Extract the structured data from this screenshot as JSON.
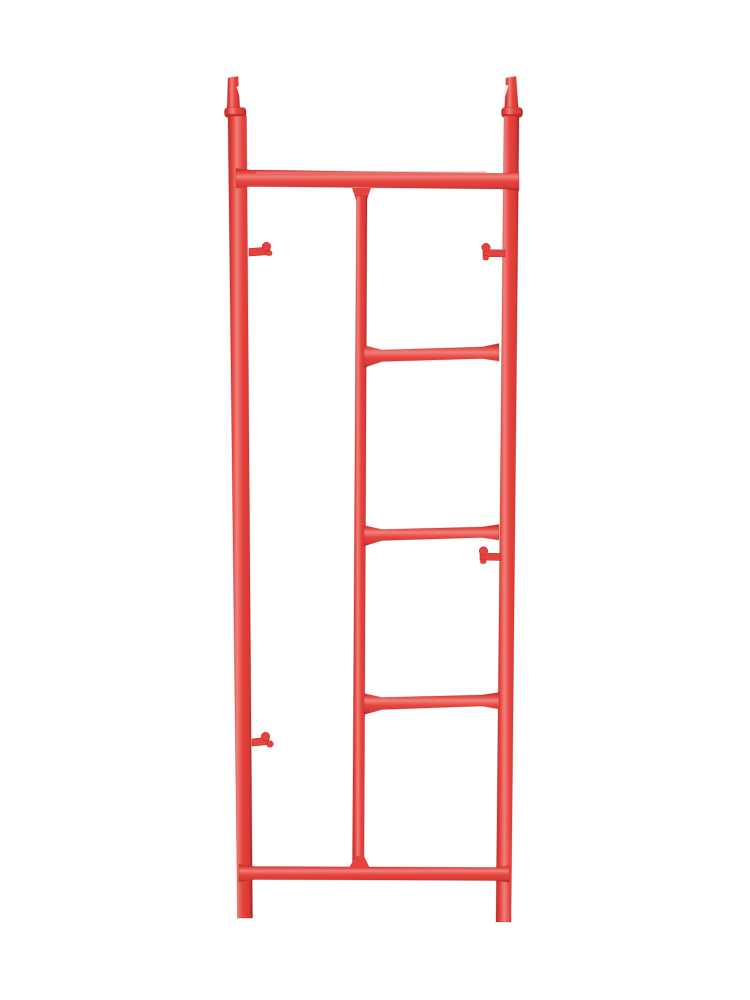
{
  "image": {
    "kind": "product-photo",
    "subject": "Red steel walk-through ladder scaffolding end frame with top coupling pins and brace lock studs on a white background",
    "background": "#ffffff"
  },
  "colors": {
    "background": "#ffffff",
    "red-main": "#e6433d",
    "red-mid": "#d93a35",
    "red-dark": "#bb2d29",
    "red-deep": "#9f2320",
    "red-light": "#f0807a"
  },
  "parts": {
    "legs": 2,
    "top_coupling_pins": 2,
    "coupling_collars": 2,
    "horizontal_bars": 2,
    "ladder_rungs": 3,
    "brace_lock_pins": 4
  }
}
